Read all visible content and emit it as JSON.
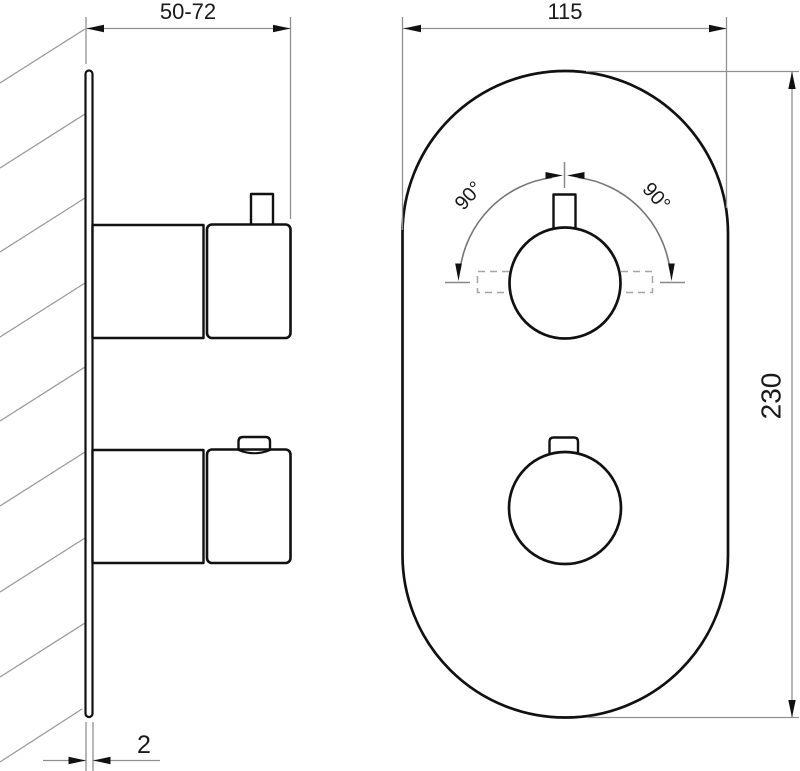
{
  "drawing": {
    "units_note": "",
    "dimensions": {
      "depth_range": "50-72",
      "plate_width": "115",
      "plate_height": "230",
      "plate_thickness": "2",
      "rotation_left": "90°",
      "rotation_right": "90°"
    },
    "colors": {
      "background": "#ffffff",
      "object_line": "#111111",
      "thin_line": "#909090",
      "dashed_line": "#a6a6a6",
      "arc_line": "#777777",
      "text": "#1a1a1a"
    }
  }
}
